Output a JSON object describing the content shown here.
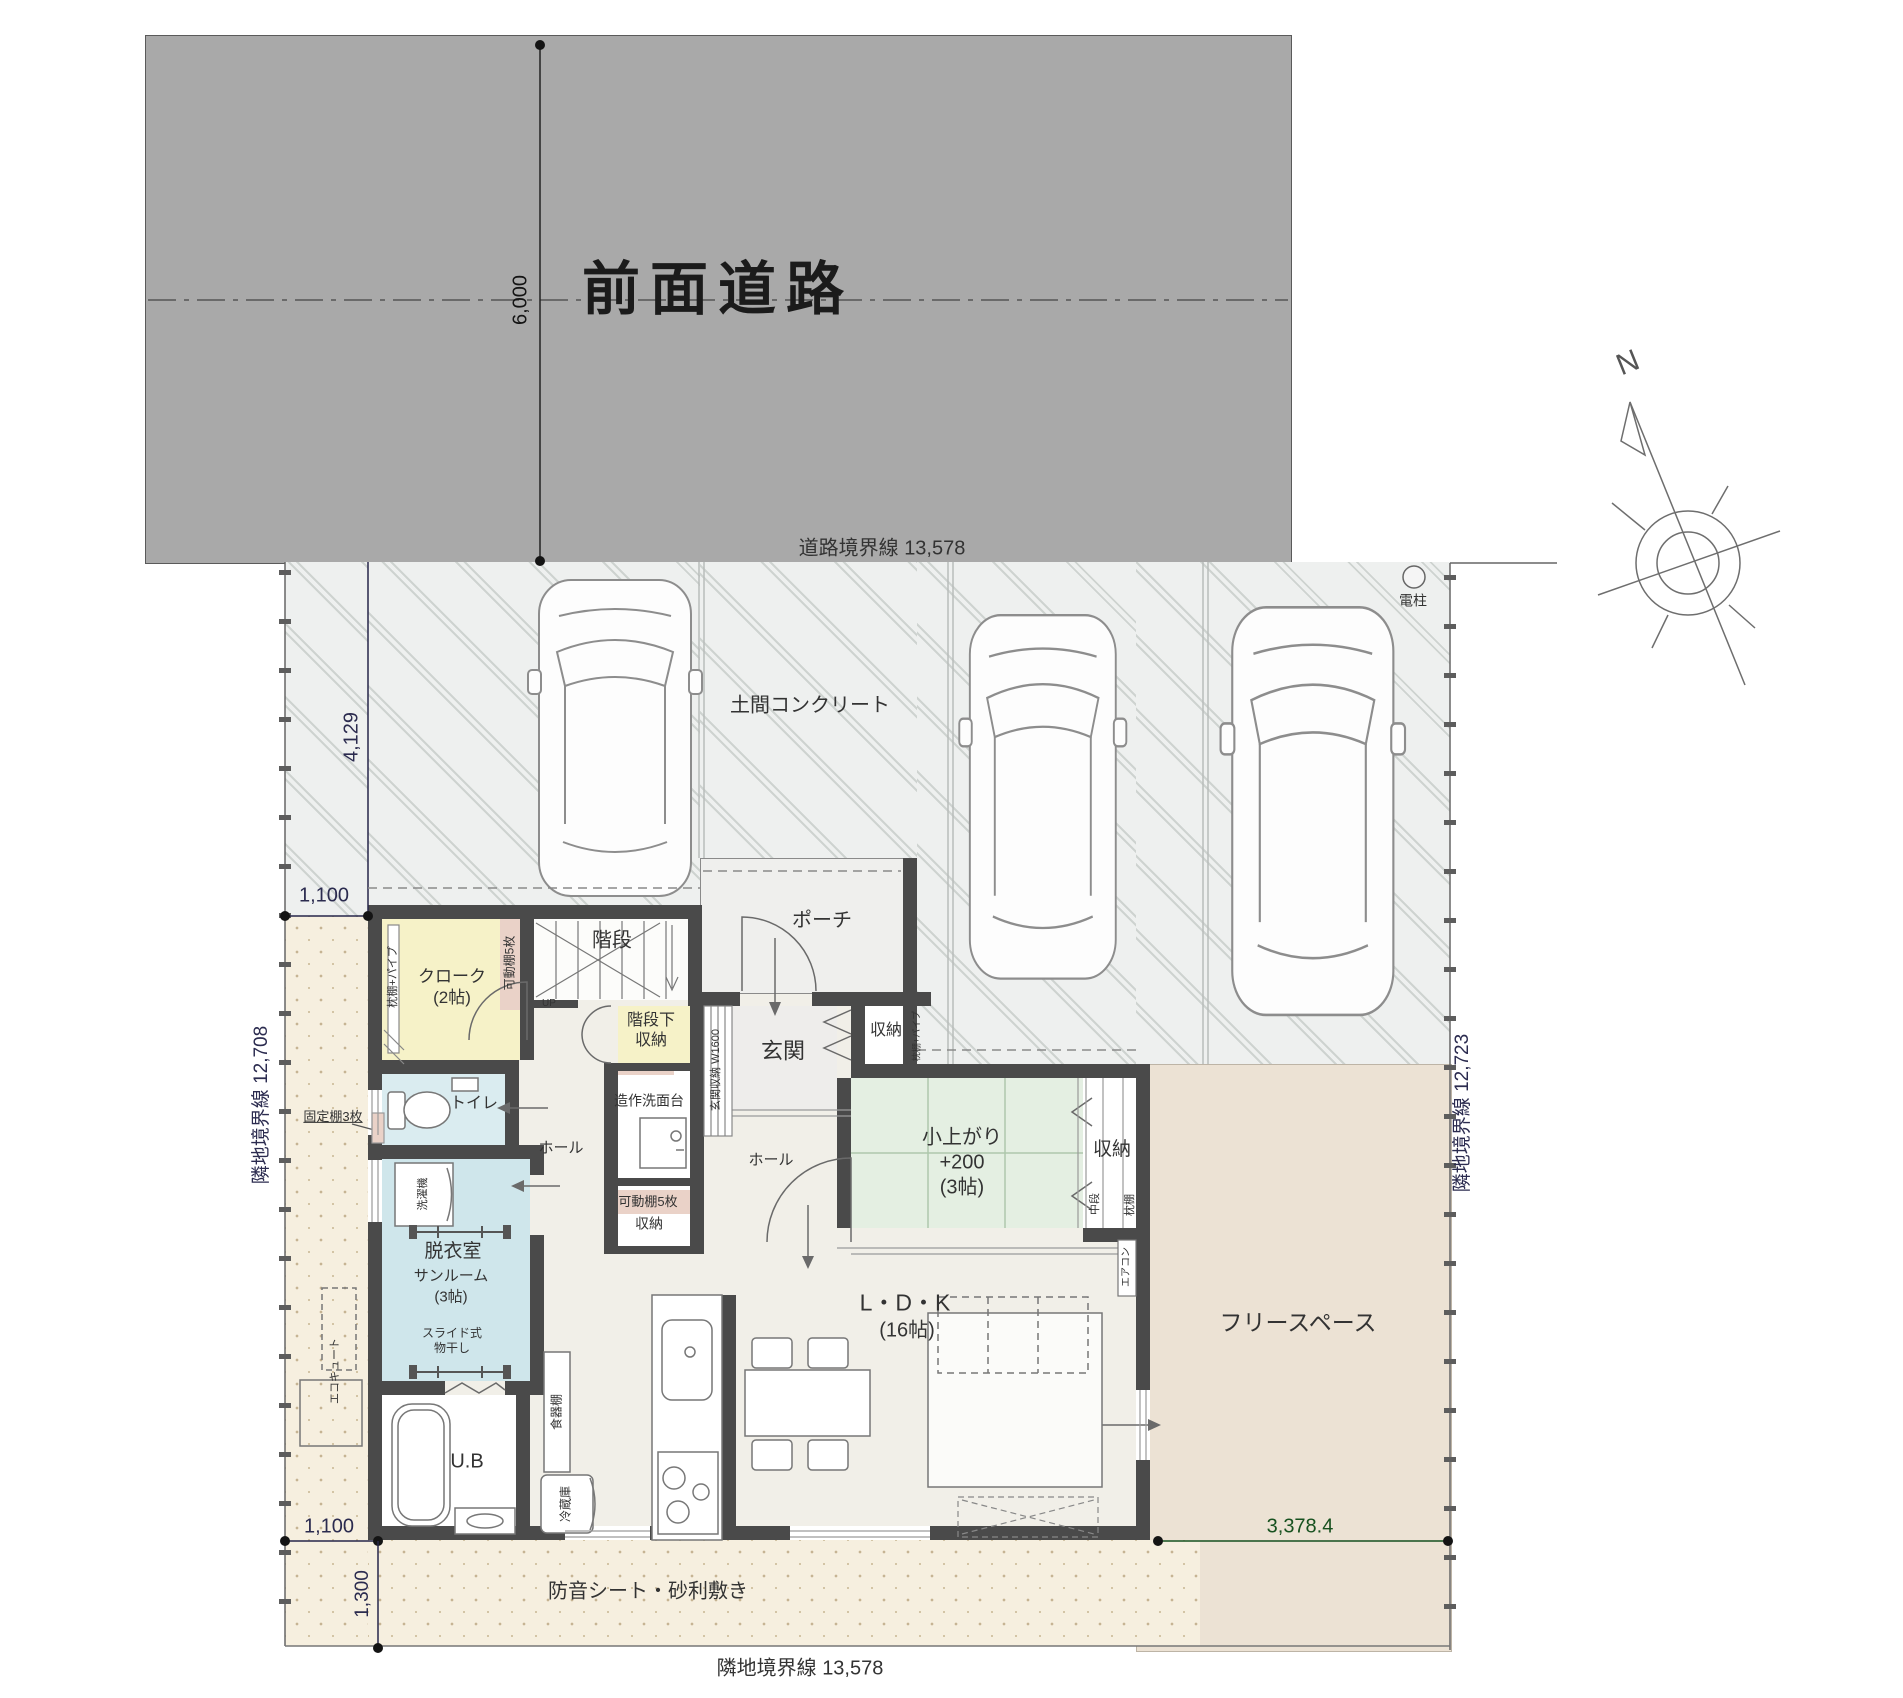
{
  "site": {
    "road_label": "前面道路",
    "road_boundary": "道路境界線  13,578",
    "parking_label": "土間コンクリート",
    "pole_label": "電柱",
    "left_boundary": "隣地境界線  12,708",
    "right_boundary": "隣地境界線  12,723",
    "bottom_boundary": "隣地境界線  13,578",
    "gravel_label": "防音シート・砂利敷き",
    "free_space": "フリースペース",
    "compass_n": "N"
  },
  "dimensions": {
    "road_width": "6,000",
    "setback": "4,129",
    "side_top": "1,100",
    "side_bottom": "1,100",
    "gravel_depth": "1,300",
    "free_space_width": "3,378.4"
  },
  "rooms": {
    "cloak": "クローク\n(2帖)",
    "cloak_shelf": "枕棚+パイプ",
    "cloak_movable": "可動棚5枚",
    "stairs": "階段",
    "stairs_up": "UP",
    "under_stairs": "階段下\n収納",
    "porch": "ポーチ",
    "entrance": "玄関",
    "entrance_cabinet": "玄関収納 W1600",
    "entrance_storage": "収納",
    "entrance_storage_shelf": "枕棚+パイプ",
    "washstand": "造作洗面台",
    "hall1": "ホール",
    "hall2": "ホール",
    "toilet": "トイレ",
    "fixed_shelf": "固定棚3枚",
    "movable_storage_shelf": "可動棚5枚",
    "movable_storage": "収納",
    "dressing": "脱衣室",
    "sunroom": "サンルーム",
    "sunroom_size": "(3帖)",
    "slide_rack": "スライド式\n物干し",
    "washer": "洗濯機",
    "ecocute": "エコキュート",
    "bath": "U.B",
    "cupboard": "食器棚",
    "fridge": "冷蔵庫",
    "ldk": "L・D・K",
    "ldk_size": "(16帖)",
    "tatami": "小上がり\n+200\n(3帖)",
    "tatami_storage": "収納",
    "tatami_mid": "中段",
    "tatami_shelf": "枕棚",
    "aircon": "エアコン"
  },
  "colors": {
    "road": "#a9a9a9",
    "wall": "#4a4a4a",
    "tatami_green": "#e4efe2",
    "cloak_yellow": "#f6f2c8",
    "wet_blue": "#cfe6eb",
    "gravel_beige": "#f6efdf",
    "free_space_beige": "#ece2d4",
    "dim_navy": "#2b2b4f",
    "dim_green": "#17511f"
  }
}
